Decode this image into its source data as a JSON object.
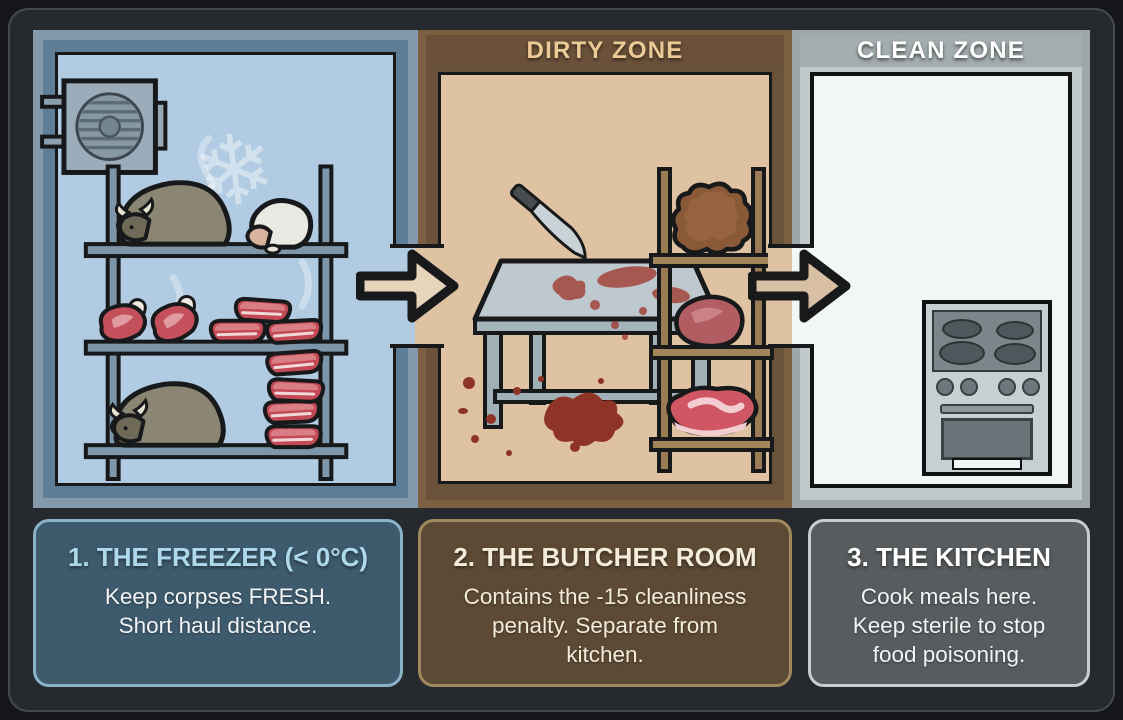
{
  "zones": {
    "dirty": {
      "label": "DIRTY ZONE"
    },
    "clean": {
      "label": "CLEAN ZONE"
    }
  },
  "rooms": {
    "freezer": {
      "name": "freezer",
      "items": [
        "cooler-unit",
        "snowflake-watermark",
        "storage-shelf",
        "muffalo-corpse",
        "sheep-corpse",
        "meat-chops",
        "steak-pile",
        "muffalo-corpse",
        "steak-stack"
      ]
    },
    "butcher": {
      "name": "butcher-room",
      "items": [
        "butcher-table",
        "knife",
        "blood-stains",
        "wooden-shelf",
        "leather-hide",
        "raw-meat-chunk",
        "steak"
      ]
    },
    "kitchen": {
      "name": "kitchen",
      "items": [
        "stove"
      ]
    }
  },
  "cards": [
    {
      "title": "1. THE FREEZER (< 0°C)",
      "body": "Keep corpses FRESH.\nShort haul distance."
    },
    {
      "title": "2. THE BUTCHER ROOM",
      "body": "Contains the -15 cleanliness\npenalty. Separate from\nkitchen."
    },
    {
      "title": "3. THE KITCHEN",
      "body": "Cook meals here.\nKeep sterile to stop\nfood poisoning."
    }
  ],
  "colors": {
    "freezer_interior": "#b0cbe2",
    "freezer_wall": "#5e7d97",
    "butcher_interior": "#dec2a1",
    "butcher_wall": "#7d5f41",
    "kitchen_interior": "#f3f6f7",
    "kitchen_wall": "#9da6a8",
    "dirty_zone_text": "#ecca96",
    "clean_zone_text": "#ffffff",
    "freezer_card_bg": "#3e5b6e",
    "freezer_card_border": "#8bb3c8",
    "freezer_card_title": "#aed9ec",
    "butcher_card_bg": "#5d4a35",
    "butcher_card_border": "#a08a5d",
    "kitchen_card_bg": "#585c5e",
    "kitchen_card_border": "#c9cdcd",
    "arrow_fill": "#e7d5bb",
    "blood": "#8e3426"
  }
}
